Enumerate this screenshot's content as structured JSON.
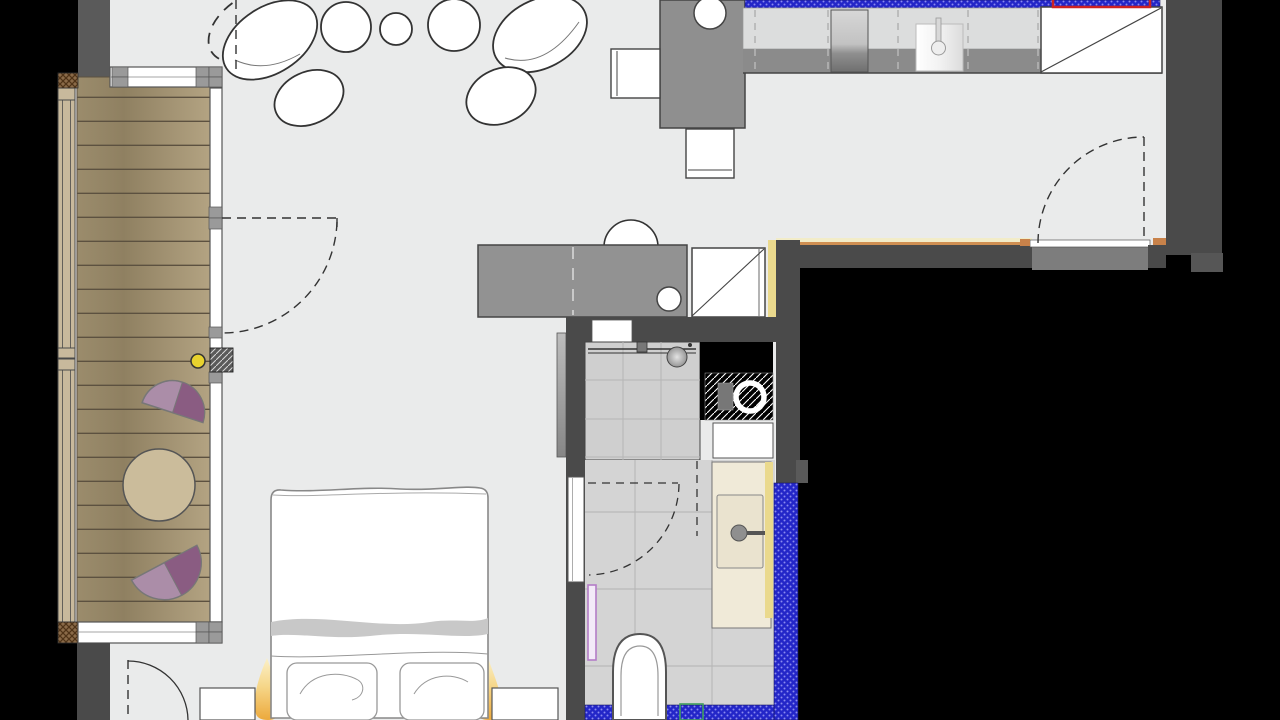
{
  "plan": {
    "type": "apartment-floor-plan",
    "rooms": [
      "balcony",
      "living-room",
      "kitchen",
      "bathroom",
      "sleeping-area",
      "entry"
    ],
    "furniture": [
      "deck-table",
      "deck-chair",
      "pebble-rug",
      "dining-table",
      "dining-chair",
      "bar-stool",
      "kitchen-island",
      "tall-fridge-unit",
      "counter-appliance",
      "shower",
      "washing-machine",
      "vanity-sink",
      "toilet",
      "towel-radiator",
      "double-bed",
      "pillow",
      "nightstand",
      "bedside-lamp"
    ]
  },
  "legend": {
    "new_wall": "blue crosshatched wall",
    "wall_finish": "yellow / orange lining",
    "highlight": "red outline marker",
    "opening_marker": "green outline marker"
  },
  "colors": {
    "floor": "#eaebeb",
    "exterior": "#000000",
    "wall_dark": "#4a4a4a",
    "wall_medium": "#5a5a5a",
    "landing_gray": "#7d7d7d",
    "deck_light": "#b3a382",
    "deck_dark": "#8f8061",
    "plank_line": "#5c5140",
    "rail_wood": "#c8b99c",
    "frame_stroke": "#555555",
    "mullion_gray": "#9a9a9a",
    "new_wall_blue": "#2326c8",
    "new_wall_dot": "#8a8af0",
    "marker_red": "#cc2222",
    "marker_green": "#3f9e5f",
    "finish_yellow": "#ead98d",
    "finish_cream": "#f2ecc8",
    "finish_orange": "#cf8f52",
    "island_gray": "#929292",
    "counter_light": "#dcdddd",
    "counter_band": "#8b8b8b",
    "chair_purple_light": "#ab8da8",
    "chair_purple_dark": "#8a5c82",
    "table_wood": "#cbbc9b",
    "tile_floor": "#d4d4d4",
    "tile_grout": "#b9b9b9",
    "shower_tile": "#cfcfcf",
    "vanity_cream": "#f0ead8",
    "sink_cream": "#eae3cf",
    "radiator_purple": "#b37cc7",
    "knob_yellow": "#e8d22e",
    "outline_dark": "#333333"
  }
}
